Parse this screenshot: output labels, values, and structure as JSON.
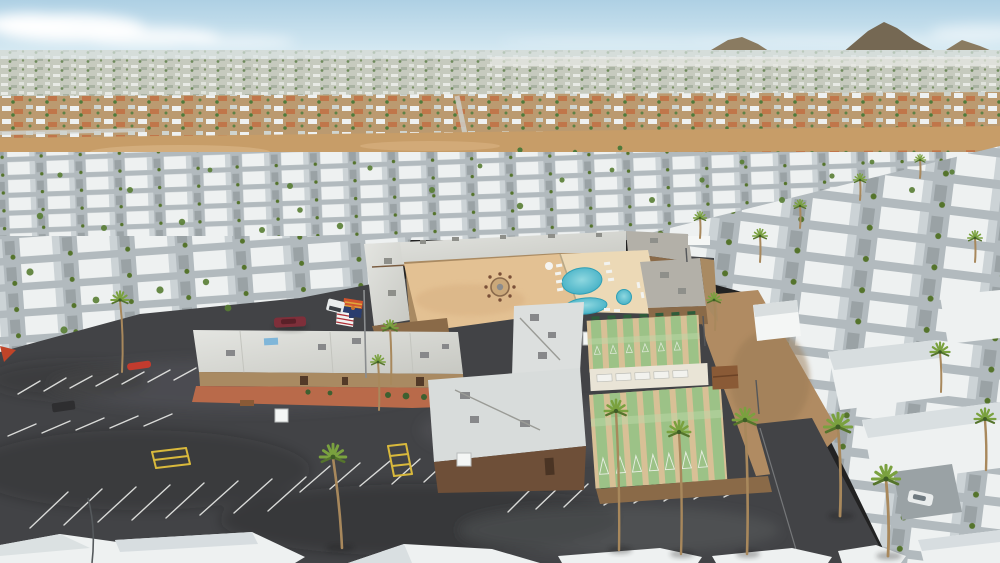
{
  "image": {
    "width": 1000,
    "height": 563,
    "kind": "aerial-drone-photo",
    "subject": "desert mobile-home park with clubhouse, courtyard fire pit, swimming pools, spa and shuffleboard courts",
    "setting": "sunny desert suburb with distant mountains on horizon"
  },
  "scene": {
    "amenities": [
      "clubhouse",
      "paver-courtyard-with-fire-pit",
      "main-pool",
      "second-pool",
      "round-spa",
      "shuffleboard-courts",
      "parking-lot",
      "gazebo"
    ],
    "shuffleboard": {
      "upper_lanes": 7,
      "lower_lanes": 8
    },
    "flags": [
      "arizona-flag",
      "us-flag"
    ],
    "vehicles": [
      "maroon-car",
      "white-truck",
      "white-car",
      "dark-van"
    ]
  },
  "palette": {
    "sky_top": "#aed0e4",
    "sky_horizon": "#ddeef5",
    "cloud": "#ffffff",
    "mountain": "#756853",
    "mountain_light": "#8a7b61",
    "city_base": "#c6cabe",
    "city_light": "#e8eae5",
    "suburb_dirt": "#bb9a70",
    "roof_orange": "#c0764a",
    "tree_green": "#4f7a3a",
    "desert": "#c79d68",
    "desert_light": "#d8b384",
    "home_roof": "#eef1f1",
    "home_roof_shade": "#ccd3d6",
    "home_gap": "#b2babe",
    "carport_gray": "#9aa2a5",
    "asphalt": "#424346",
    "asphalt_light": "#5b5d60",
    "stripe_white": "#e8e9e6",
    "stripe_yellow": "#d9b93c",
    "clubroof_a": "#e4e5e1",
    "clubroof_b": "#c7c8c2",
    "roof_gray": "#b3b0a8",
    "wall_tan": "#a98a62",
    "wall_brown": "#8a6a48",
    "wall_dark": "#6e4f38",
    "paver": "#e3c193",
    "deck": "#ecd9b6",
    "terracotta": "#b96a4a",
    "pool_light": "#8fd8e0",
    "pool_deep": "#35a8c0",
    "court_tan": "#d8c096",
    "court_green": "#9cc287",
    "court_green_light": "#bcd8a8",
    "bench_green": "#2e5c3a",
    "walk_light": "#e9e4d6",
    "dirt_road": "#b08b62",
    "palm_green": "#7aa13f",
    "palm_dark": "#55742c",
    "palm_trunk": "#a8885c",
    "gazebo": "#8a5a36",
    "white_struct": "#f4f6f5",
    "flag_red": "#d2542e",
    "flag_yellow": "#e0a83c",
    "flag_blue": "#2a3d6e",
    "flag_star": "#c8722e",
    "us_red": "#b03038",
    "car_maroon": "#7e2f3a",
    "car_white": "#e9ecec",
    "skylight_blue": "#7fb6d9"
  }
}
